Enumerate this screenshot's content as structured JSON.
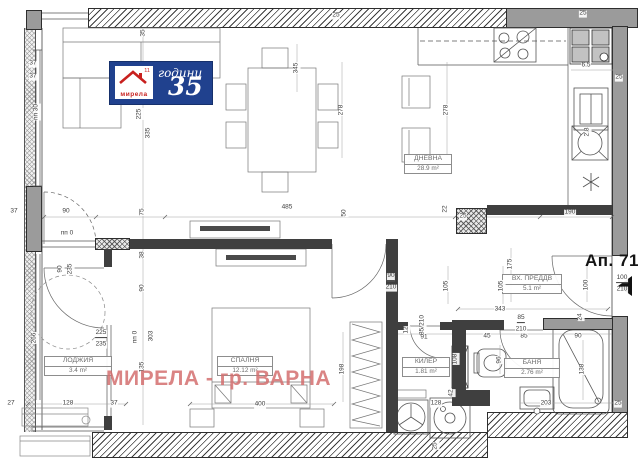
{
  "plan": {
    "apartment": "Ап. 71",
    "watermark": "МИРЕЛА - гр. ВАРНА",
    "logo": {
      "brand": "мирела",
      "top_word": "години",
      "number": "35",
      "mark": "11"
    },
    "rooms": [
      {
        "name": "ДНЕВНА",
        "area": "28.9 m²"
      },
      {
        "name": "СПАЛНЯ",
        "area": "12.12 m²"
      },
      {
        "name": "ЛОДЖИЯ",
        "area": "3.4 m²"
      },
      {
        "name": "ВХ. ПРЕДДВ",
        "area": "5.1 m²"
      },
      {
        "name": "КИЛЕР",
        "area": "1.81 m²"
      },
      {
        "name": "БАНЯ",
        "area": "2.76 m²"
      }
    ],
    "dimensions": [
      {
        "t": "37",
        "x": 14,
        "y": 212
      },
      {
        "t": "90",
        "x": 66,
        "y": 212
      },
      {
        "t": "485",
        "x": 287,
        "y": 208
      },
      {
        "t": "22",
        "x": 446,
        "y": 209,
        "r": -90
      },
      {
        "t": "25",
        "x": 463,
        "y": 217
      },
      {
        "t": "190",
        "x": 570,
        "y": 213
      },
      {
        "t": "50",
        "x": 345,
        "y": 213,
        "r": -90
      },
      {
        "t": "37",
        "x": 33,
        "y": 64
      },
      {
        "t": "37",
        "x": 33,
        "y": 77
      },
      {
        "t": "пп 30",
        "x": 37,
        "y": 112,
        "r": -90
      },
      {
        "t": "225",
        "x": 140,
        "y": 114,
        "r": -90
      },
      {
        "t": "335",
        "x": 149,
        "y": 133,
        "r": -90
      },
      {
        "t": "75",
        "x": 143,
        "y": 212,
        "r": -90
      },
      {
        "t": "35",
        "x": 144,
        "y": 33,
        "r": -90
      },
      {
        "t": "345",
        "x": 297,
        "y": 68,
        "r": -90
      },
      {
        "t": "25",
        "x": 336,
        "y": 16
      },
      {
        "t": "278",
        "x": 342,
        "y": 110,
        "r": -90
      },
      {
        "t": "278",
        "x": 447,
        "y": 110,
        "r": -90
      },
      {
        "t": "25",
        "x": 583,
        "y": 14
      },
      {
        "t": "6.5",
        "x": 586,
        "y": 66
      },
      {
        "t": "25",
        "x": 619,
        "y": 78
      },
      {
        "t": "2.8",
        "x": 588,
        "y": 132,
        "r": -90
      },
      {
        "t": "пп 0",
        "x": 67,
        "y": 234
      },
      {
        "t": "90",
        "x": 61,
        "y": 269,
        "r": -90
      },
      {
        "t": "235",
        "x": 71,
        "y": 269,
        "r": -90
      },
      {
        "t": "266",
        "x": 35,
        "y": 338,
        "r": -90
      },
      {
        "t": "225",
        "x": 101,
        "y": 334,
        "u": 1
      },
      {
        "t": "235",
        "x": 101,
        "y": 345
      },
      {
        "t": "38",
        "x": 143,
        "y": 255,
        "r": -90
      },
      {
        "t": "90",
        "x": 143,
        "y": 288,
        "r": -90
      },
      {
        "t": "пп 0",
        "x": 136,
        "y": 337,
        "r": -90
      },
      {
        "t": "303",
        "x": 152,
        "y": 336,
        "r": -90
      },
      {
        "t": "135",
        "x": 143,
        "y": 367,
        "r": -90
      },
      {
        "t": "27",
        "x": 11,
        "y": 404
      },
      {
        "t": "128",
        "x": 68,
        "y": 404
      },
      {
        "t": "37",
        "x": 114,
        "y": 404
      },
      {
        "t": "400",
        "x": 260,
        "y": 405
      },
      {
        "t": "198",
        "x": 343,
        "y": 369,
        "r": -90
      },
      {
        "t": "90",
        "x": 391,
        "y": 277,
        "u": 1
      },
      {
        "t": "210",
        "x": 391,
        "y": 288
      },
      {
        "t": "105",
        "x": 447,
        "y": 286,
        "r": -90
      },
      {
        "t": "105",
        "x": 502,
        "y": 286,
        "r": -90
      },
      {
        "t": "175",
        "x": 511,
        "y": 264,
        "r": -90
      },
      {
        "t": "343",
        "x": 500,
        "y": 310
      },
      {
        "t": "100",
        "x": 587,
        "y": 285,
        "r": -90
      },
      {
        "t": "100",
        "x": 622,
        "y": 279,
        "u": 1
      },
      {
        "t": "210",
        "x": 622,
        "y": 290
      },
      {
        "t": "85/210",
        "x": 423,
        "y": 325,
        "r": -90
      },
      {
        "t": "91",
        "x": 424,
        "y": 338
      },
      {
        "t": "12",
        "x": 407,
        "y": 330,
        "r": -90
      },
      {
        "t": "45",
        "x": 487,
        "y": 337
      },
      {
        "t": "85",
        "x": 524,
        "y": 337
      },
      {
        "t": "85",
        "x": 521,
        "y": 319,
        "u": 1
      },
      {
        "t": "210",
        "x": 521,
        "y": 330
      },
      {
        "t": "90",
        "x": 578,
        "y": 337
      },
      {
        "t": "108",
        "x": 456,
        "y": 359,
        "r": -90
      },
      {
        "t": "96",
        "x": 500,
        "y": 360,
        "r": -90
      },
      {
        "t": "42",
        "x": 452,
        "y": 393,
        "r": -90
      },
      {
        "t": "128",
        "x": 436,
        "y": 404
      },
      {
        "t": "203",
        "x": 546,
        "y": 404
      },
      {
        "t": "25",
        "x": 618,
        "y": 404
      },
      {
        "t": "138",
        "x": 583,
        "y": 369,
        "r": -90
      },
      {
        "t": "25",
        "x": 436,
        "y": 446,
        "r": -90
      },
      {
        "t": "24",
        "x": 581,
        "y": 317,
        "r": -90
      }
    ]
  },
  "colors": {
    "logo_blue": "#20418e",
    "logo_red": "#c8201e",
    "watermark_pink": "#d46e6e",
    "wall_dark": "#3f3f3f",
    "wall_gray": "#9b9b9b",
    "line": "#555555"
  }
}
